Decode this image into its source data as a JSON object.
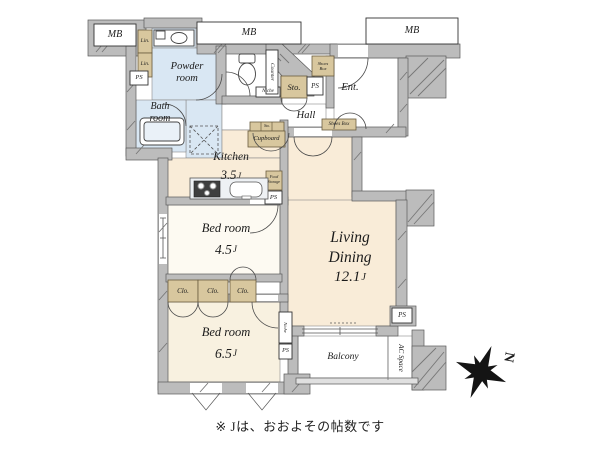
{
  "floorplan": {
    "rooms": {
      "powder_room": "Powder\nroom",
      "bath_room": "Bath\nroom",
      "kitchen": "Kitchen",
      "kitchen_size": "3.5",
      "living": "Living",
      "dining": "Dining",
      "living_dining_size": "12.1",
      "bedroom_a": "Bed room",
      "bedroom_a_size": "4.5",
      "bedroom_b": "Bed room",
      "bedroom_b_size": "6.5",
      "hall": "Hall",
      "entrance": "Ent.",
      "balcony": "Balcony",
      "ac_space": "AC Space"
    },
    "size_unit": "J",
    "labels": {
      "mb": "MB",
      "ps": "PS",
      "lin": "Lin.",
      "sto": "Sto.",
      "clo": "Clo.",
      "cupboard": "Cupboard",
      "shoes_box": "Shoes Box",
      "shoes_box_stacked": "Shoes\nBox",
      "niche": "Niche",
      "counter": "Counter",
      "food_storage": "Food\nStorage"
    },
    "compass": {
      "north_letter": "N"
    },
    "footnote": "※ Jは、おおよその帖数です",
    "colors": {
      "wall": "#bcbcbc",
      "water_room_floor": "#d9e7f3",
      "main_floor": "#f9ecd8",
      "storage_fill": "#d8c79e",
      "background": "#ffffff"
    }
  }
}
